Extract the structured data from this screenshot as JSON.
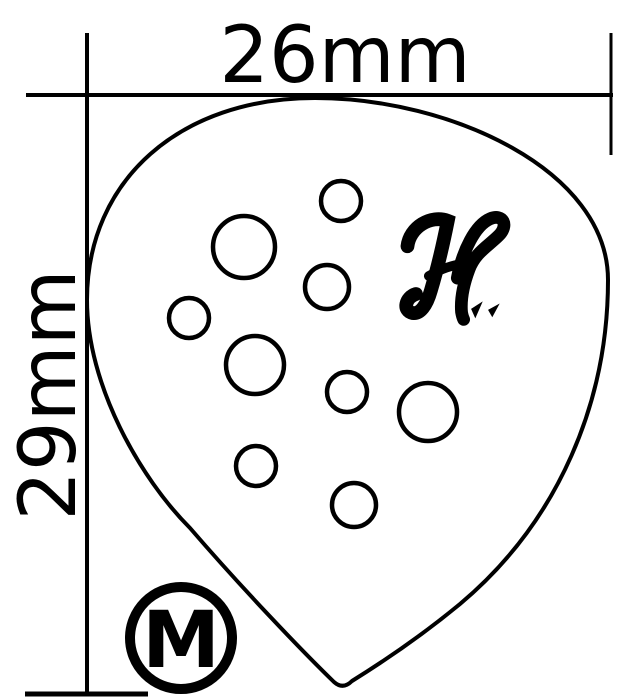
{
  "diagram": {
    "type": "technical-dimension-drawing",
    "subject": "guitar-pick",
    "width_label": "26mm",
    "height_label": "29mm",
    "gauge_label": "M",
    "brand_logo_letter": "H",
    "colors": {
      "line": "#000000",
      "background": "#ffffff"
    },
    "holes": [
      {
        "cx": 341,
        "cy": 201,
        "r": 20
      },
      {
        "cx": 244,
        "cy": 247,
        "r": 31
      },
      {
        "cx": 327,
        "cy": 287,
        "r": 22
      },
      {
        "cx": 189,
        "cy": 318,
        "r": 20
      },
      {
        "cx": 255,
        "cy": 365,
        "r": 29
      },
      {
        "cx": 347,
        "cy": 392,
        "r": 20
      },
      {
        "cx": 428,
        "cy": 412,
        "r": 29
      },
      {
        "cx": 256,
        "cy": 466,
        "r": 20
      },
      {
        "cx": 354,
        "cy": 505,
        "r": 22
      }
    ]
  }
}
